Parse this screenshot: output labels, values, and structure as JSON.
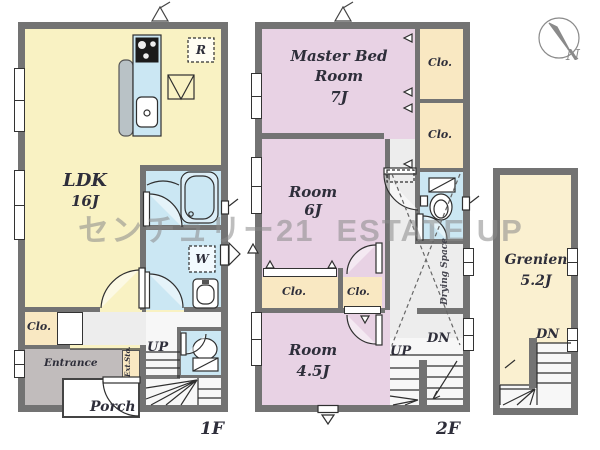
{
  "watermark": {
    "jp": "センチュリー21",
    "en": "ESTATE UP"
  },
  "compass": {
    "north": "N"
  },
  "floor1": {
    "label": "1F",
    "ldk_name": "LDK",
    "ldk_size": "16J",
    "closet": "Clo.",
    "entrance": "Entrance",
    "porch": "Porch",
    "ext_storage": "Ext.Sto.",
    "up": "UP",
    "washer": "W",
    "fridge": "R"
  },
  "floor2": {
    "label": "2F",
    "master_name": "Master Bed Room",
    "master_size": "7J",
    "room6_name": "Room",
    "room6_size": "6J",
    "room45_name": "Room",
    "room45_size": "4.5J",
    "closet_right_top": "Clo.",
    "closet_right_bottom": "Clo.",
    "closet_mid_left": "Clo.",
    "closet_mid_right": "Clo.",
    "drying_space": "Drying Space",
    "up": "UP",
    "down": "DN"
  },
  "loft": {
    "name": "Grenien",
    "size": "5.2J",
    "down": "DN"
  },
  "colors": {
    "wall": "#737373",
    "yellow": "#f9f2c3",
    "pink": "#e8d2e4",
    "cream": "#f9e8c2",
    "loftcream": "#faf0d0",
    "blue": "#cbe7f3",
    "hall": "#ededed",
    "entrance": "#c1bcbc",
    "line": "#2f2f2f",
    "label": "#2e2e3a",
    "watermark": "#8a8a8a"
  }
}
